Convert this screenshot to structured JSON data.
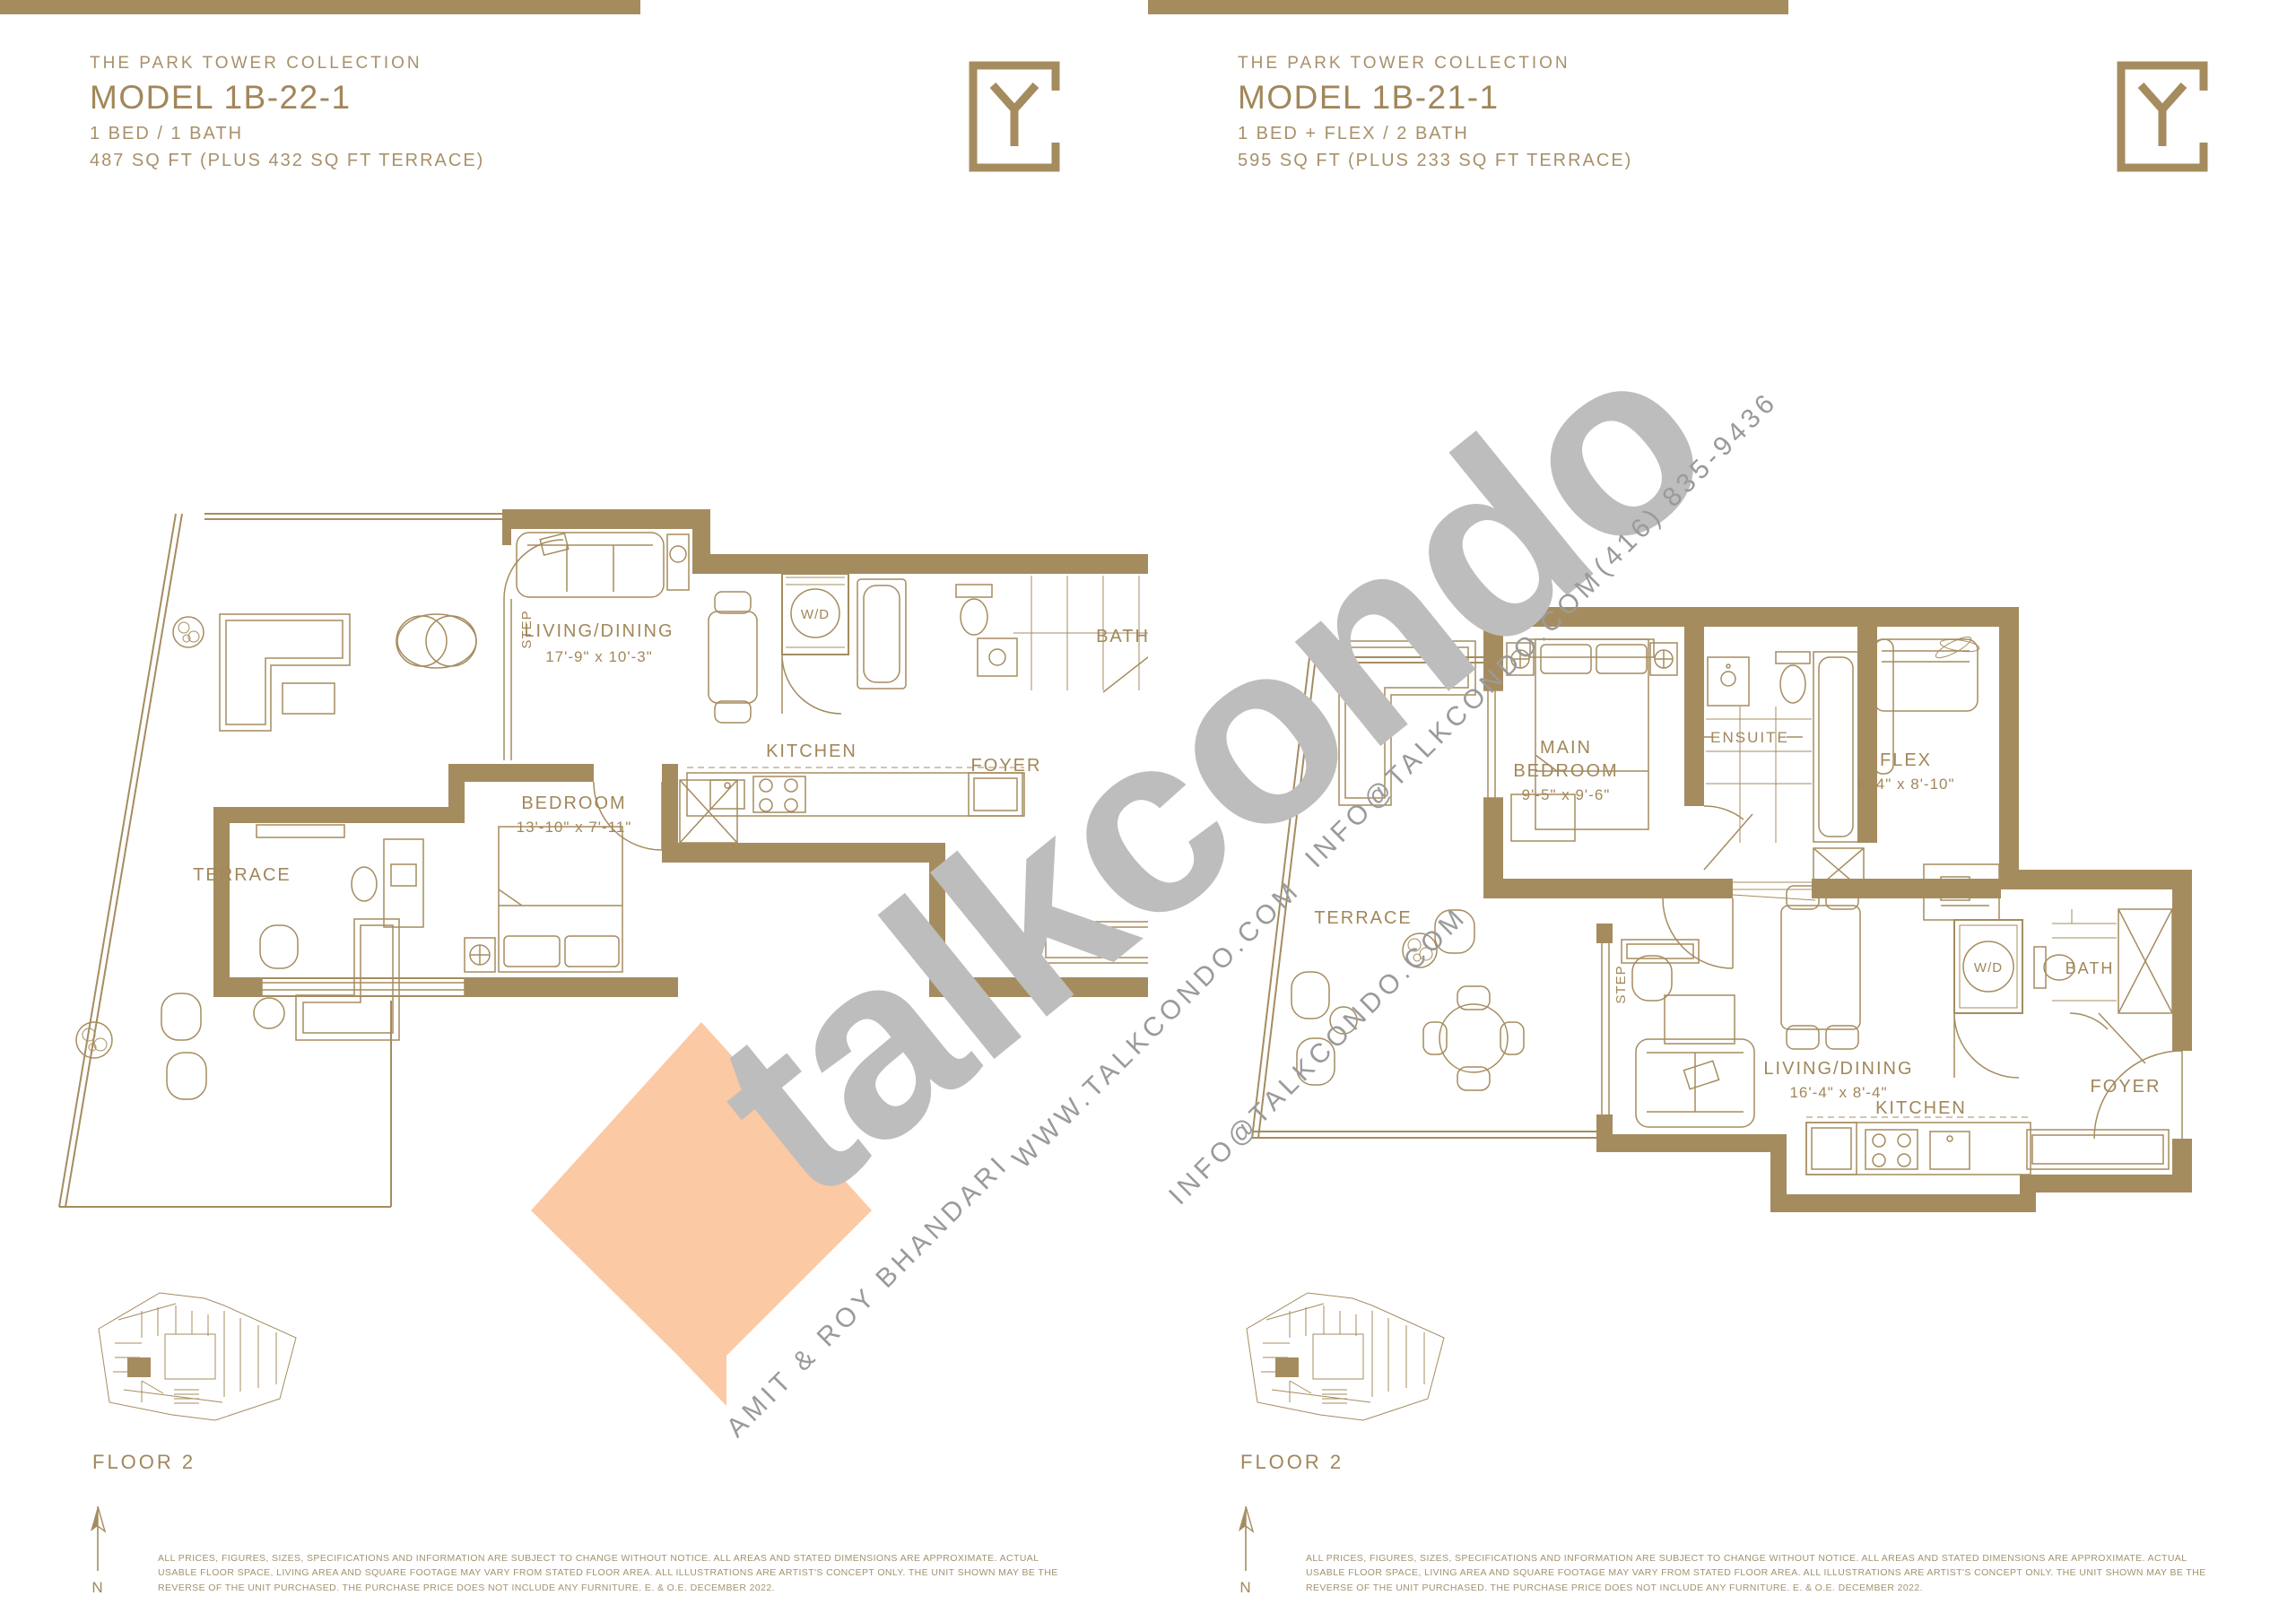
{
  "document": {
    "brand_watermark": "talkcondo",
    "phone": "(416) 835-9436",
    "email": "INFO@TALKCONDO.COM",
    "website": "WWW.TALKCONDO.COM",
    "agents": "AMIT & ROY BHANDARI",
    "colors": {
      "gold": "#A58C5F",
      "peach": "#FBC9A3",
      "gray": "#BDBDBD"
    }
  },
  "panels": [
    {
      "collection": "THE PARK TOWER COLLECTION",
      "model": "MODEL 1B-22-1",
      "config": "1 BED / 1 BATH",
      "area": "487 SQ FT (PLUS 432 SQ FT TERRACE)",
      "floor_label": "FLOOR 2",
      "north_label": "N",
      "disclaimer_line1": "ALL PRICES, FIGURES, SIZES, SPECIFICATIONS AND INFORMATION ARE SUBJECT TO CHANGE WITHOUT NOTICE. ALL AREAS AND STATED DIMENSIONS ARE APPROXIMATE. ACTUAL USABLE FLOOR SPACE, LIVING AREA AND SQUARE FOOTAGE MAY VARY FROM STATED FLOOR",
      "disclaimer_line2": "AREA. ALL ILLUSTRATIONS ARE ARTIST'S CONCEPT ONLY. THE UNIT SHOWN MAY BE THE REVERSE OF THE UNIT PURCHASED. THE PURCHASE PRICE DOES NOT INCLUDE ANY FURNITURE. E. & O.E. DECEMBER 2022.",
      "rooms": {
        "terrace": "TERRACE",
        "step": "STEP",
        "living": "LIVING/DINING",
        "living_dim": "17'-9\" x 10'-3\"",
        "wd": "W/D",
        "bath": "BATH",
        "kitchen": "KITCHEN",
        "foyer": "FOYER",
        "bedroom": "BEDROOM",
        "bedroom_dim": "13'-10\" x 7'-11\""
      }
    },
    {
      "collection": "THE PARK TOWER COLLECTION",
      "model": "MODEL 1B-21-1",
      "config": "1 BED + FLEX / 2 BATH",
      "area": "595 SQ FT (PLUS 233 SQ FT TERRACE)",
      "floor_label": "FLOOR 2",
      "north_label": "N",
      "disclaimer_line1": "ALL PRICES, FIGURES, SIZES, SPECIFICATIONS AND INFORMATION ARE SUBJECT TO CHANGE WITHOUT NOTICE. ALL AREAS AND STATED DIMENSIONS ARE APPROXIMATE. ACTUAL USABLE FLOOR SPACE, LIVING AREA AND SQUARE FOOTAGE MAY VARY FROM STATED FLOOR",
      "disclaimer_line2": "AREA. ALL ILLUSTRATIONS ARE ARTIST'S CONCEPT ONLY. THE UNIT SHOWN MAY BE THE REVERSE OF THE UNIT PURCHASED. THE PURCHASE PRICE DOES NOT INCLUDE ANY FURNITURE. E. & O.E. DECEMBER 2022.",
      "rooms": {
        "terrace": "TERRACE",
        "step": "STEP",
        "main_bedroom_line1": "MAIN",
        "main_bedroom_line2": "BEDROOM",
        "main_bedroom_dim": "9'-5\" x 9'-6\"",
        "ensuite": "ENSUITE",
        "flex": "FLEX",
        "flex_dim": "6'-4\" x 8'-10\"",
        "living": "LIVING/DINING",
        "living_dim": "16'-4\" x 8'-4\"",
        "wd": "W/D",
        "bath": "BATH",
        "kitchen": "KITCHEN",
        "foyer": "FOYER"
      }
    }
  ]
}
